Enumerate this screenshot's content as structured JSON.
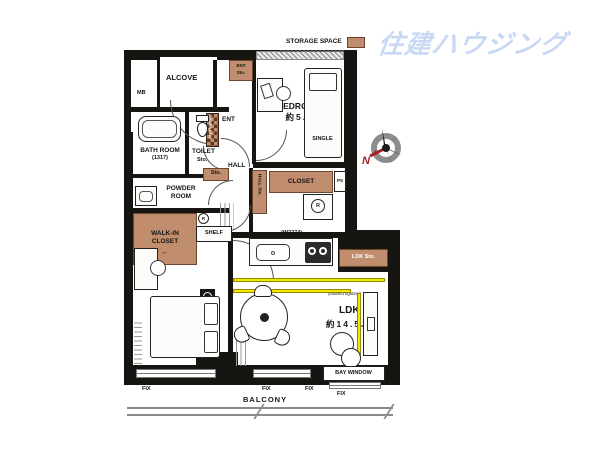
{
  "logo": {
    "text": "住建ハウジング",
    "color": "#c9d9f4"
  },
  "legend": {
    "storage_space": "STORAGE SPACE",
    "storage_color": "#c08d6e"
  },
  "compass": {
    "north": "N"
  },
  "colors": {
    "wall": "#171512",
    "storage_box": "#c08d6e",
    "indirect_lighting": "#f2e50a"
  },
  "labels": {
    "mb": "MB",
    "alcove": "ALCOVE",
    "ent": "ENT",
    "ent_sto_1": "ENT",
    "ent_sto_2": "Sto.",
    "shoes_box": "SHOES BOX",
    "bedroom1": "BEDROOM①",
    "bedroom1_size": "約5.9J",
    "single": "SINGLE",
    "bathroom": "BATH ROOM",
    "bathroom_size": "(1317)",
    "toilet": "TOILET",
    "toilet_sto": "Sto.",
    "sto": "Sto.",
    "hall": "HALL",
    "hall_sto": "HALL Sto.",
    "closet": "CLOSET",
    "ps": "PS",
    "powder_room_1": "POWDER",
    "powder_room_2": "ROOM",
    "walk_in_closet_1": "WALK-IN",
    "walk_in_closet_2": "CLOSET",
    "wic_arrow": "←",
    "shelf": "SHELF",
    "bedroom2": "BEDROOM②",
    "bedroom2_size": "約6.1J",
    "double": "DOUBLE",
    "kitchen_width": "(W2274)",
    "ldk_sto": "LDK Sto.",
    "ldk": "LDK",
    "ldk_size": "約14.5J",
    "indirect_lighting": "(indirect lighting)",
    "bay_window": "BAY WINDOW",
    "fix": "FIX",
    "balcony": "BALCONY",
    "circle_r": "R"
  }
}
